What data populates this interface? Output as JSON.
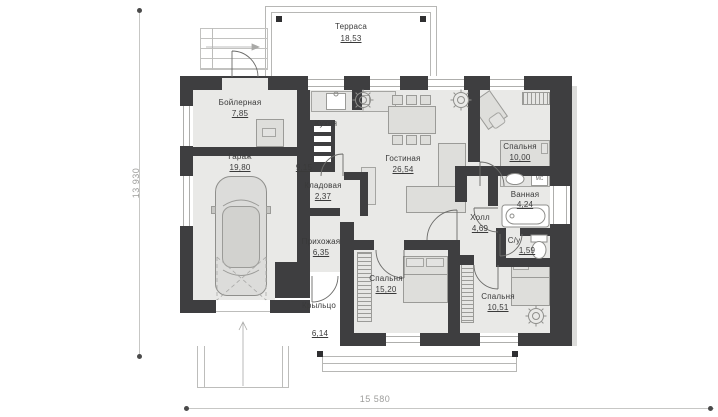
{
  "plan": {
    "terrace": {
      "name": "Терраса",
      "area": "18,53"
    },
    "rooms": {
      "boiler": {
        "name": "Бойлерная",
        "area": "7,85"
      },
      "garage": {
        "name": "Гараж",
        "area": "19,80"
      },
      "kitchen": {
        "name": "Кухня",
        "area": "9,15"
      },
      "pantry": {
        "name": "Кладовая",
        "area": "2,37"
      },
      "living": {
        "name": "Гостиная",
        "area": "26,54"
      },
      "bedroom1": {
        "name": "Спальня",
        "area": "10,00"
      },
      "bathroom": {
        "name": "Ванная",
        "area": "4,24"
      },
      "hall": {
        "name": "Холл",
        "area": "4,69"
      },
      "wc": {
        "name": "С/у",
        "area": "1,59"
      },
      "entry": {
        "name": "Прихожая",
        "area": "6,35"
      },
      "porch": {
        "name": "Крыльцо",
        "area": "6,14"
      },
      "bedroom2": {
        "name": "Спальня",
        "area": "15,20"
      },
      "bedroom3": {
        "name": "Спальня",
        "area": "10,51"
      }
    },
    "dimensions": {
      "width": "15 580",
      "height": "13 930"
    },
    "appliances": {
      "washer": "МС"
    },
    "colors": {
      "wall": "#3e3e40",
      "floor": "#e9e9e7",
      "line": "#bdbdbb"
    }
  }
}
